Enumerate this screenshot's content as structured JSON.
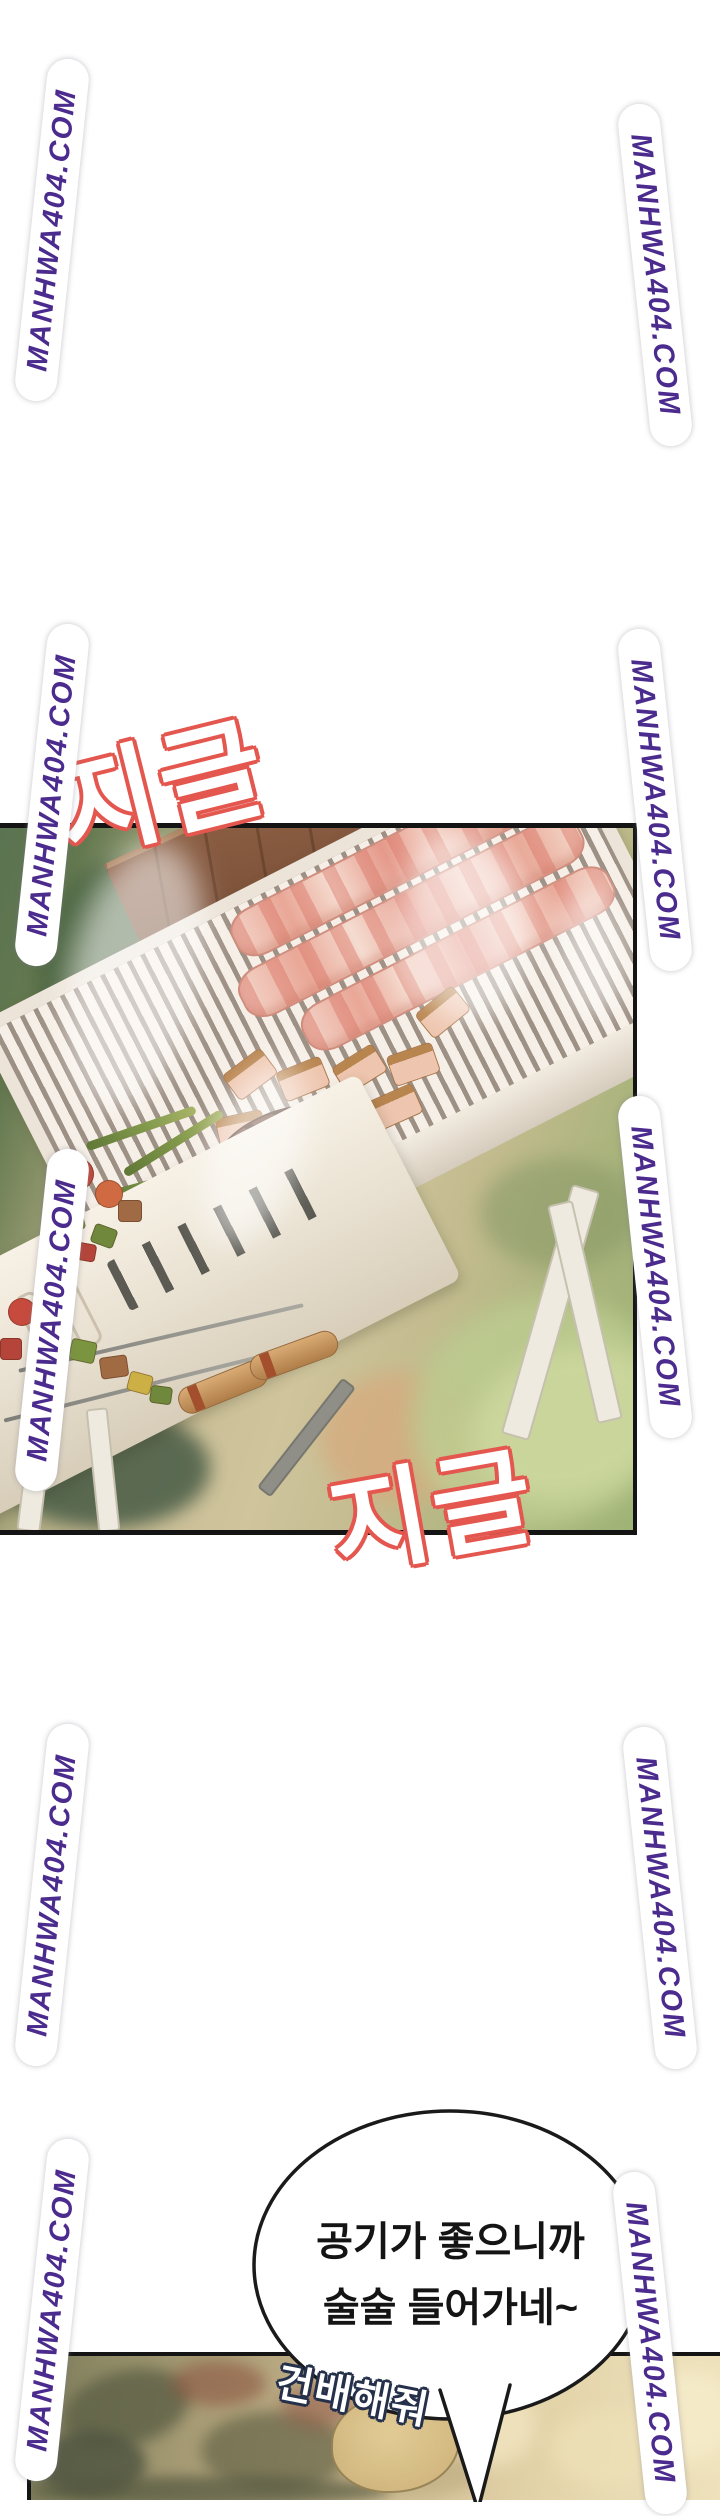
{
  "page": {
    "width": 720,
    "height": 2500,
    "background": "#ffffff"
  },
  "watermark": {
    "text": "MANHWA404.COM",
    "color": "#4b2b8d",
    "halo_color": "#ffffff",
    "instances": [
      {
        "side": "left",
        "cx": 52,
        "cy": 230
      },
      {
        "side": "left",
        "cx": 52,
        "cy": 795
      },
      {
        "side": "left",
        "cx": 52,
        "cy": 1320
      },
      {
        "side": "left",
        "cx": 52,
        "cy": 1895
      },
      {
        "side": "left",
        "cx": 52,
        "cy": 2310
      },
      {
        "side": "right",
        "cx": 655,
        "cy": 275
      },
      {
        "side": "right",
        "cx": 655,
        "cy": 800
      },
      {
        "side": "right",
        "cx": 655,
        "cy": 1267
      },
      {
        "side": "right",
        "cx": 660,
        "cy": 1898
      },
      {
        "side": "right",
        "cx": 650,
        "cy": 2343
      }
    ]
  },
  "sfx": {
    "fill": "#ffffff",
    "outline": "#e4574f",
    "items": [
      {
        "text": "지글"
      },
      {
        "text": "지글"
      }
    ]
  },
  "panels": [
    {
      "id": "grill-panel",
      "description": "Tabletop grill outdoors: pork belly strips, cut meat pieces, green onions, a steak and vegetable skewers over a striped grill; grass below"
    },
    {
      "id": "outdoor-panel",
      "description": "Blurry warm outdoor foliage scene, partially cut off at page bottom"
    }
  ],
  "speech_bubble": {
    "fill": "#ffffff",
    "stroke": "#1a1a1a",
    "text_color": "#141414",
    "lines": [
      "공기가 좋으니까",
      "술술 들어가네~"
    ]
  },
  "caption": {
    "text": "건배해줘",
    "fill": "#ffffff",
    "outline": "#25304a"
  }
}
